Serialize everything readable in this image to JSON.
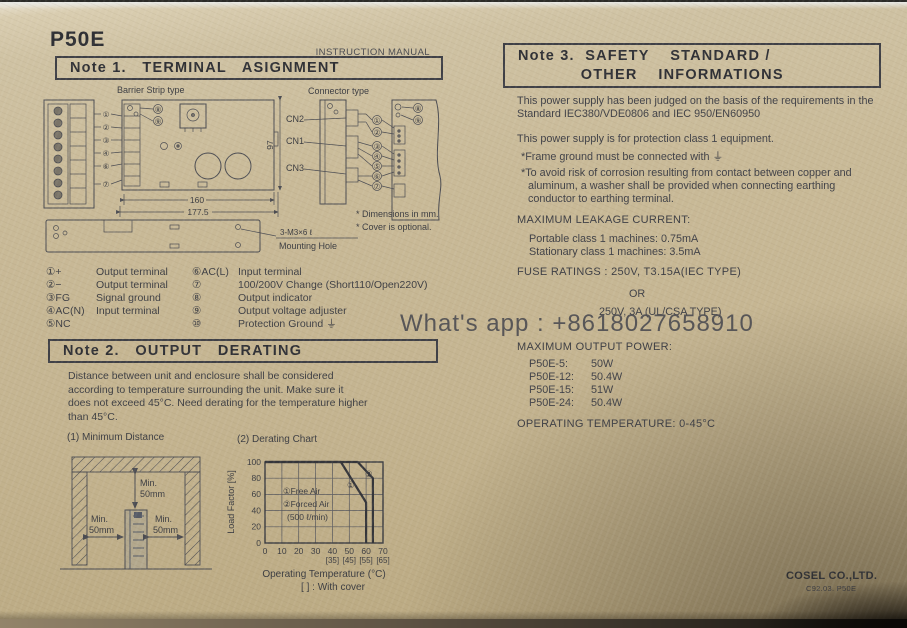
{
  "page": {
    "product_title": "P50E",
    "doc_type": "INSTRUCTION MANUAL",
    "watermark": "What's app : +8618027658910",
    "footer_company": "COSEL CO.,LTD.",
    "footer_code": "C92.03. P50E"
  },
  "note1": {
    "title": "Note 1.   TERMINAL   ASIGNMENT",
    "diagram": {
      "barrier_label": "Barrier Strip type",
      "connector_label": "Connector type",
      "cn2": "CN2",
      "cn1": "CN1",
      "cn3": "CN3",
      "dim_inner": "160",
      "dim_outer": "177.5",
      "dim_height": "97",
      "mounting_spec": "3-M3×6 ℓ",
      "mounting_label": "Mounting Hole",
      "note_dimensions": "* Dimensions in mm.",
      "note_cover": "* Cover is optional.",
      "callouts_left": [
        "①",
        "②",
        "③",
        "④",
        "⑥",
        "⑦"
      ],
      "callouts_mid": [
        "①",
        "②",
        "③",
        "④",
        "⑤",
        "⑥",
        "⑦"
      ],
      "callout_8": "⑧",
      "callout_9": "⑨"
    },
    "legend_left": [
      {
        "head": "①+",
        "desc": "Output terminal"
      },
      {
        "head": "②−",
        "desc": "Output terminal"
      },
      {
        "head": "③FG",
        "desc": "Signal ground"
      },
      {
        "head": "④AC(N)",
        "desc": "Input terminal"
      },
      {
        "head": "⑤NC",
        "desc": ""
      }
    ],
    "legend_right": [
      {
        "head": "⑥AC(L)",
        "desc": "Input terminal"
      },
      {
        "head": "⑦",
        "desc": "100/200V Change (Short110/Open220V)"
      },
      {
        "head": "⑧",
        "desc": "Output indicator"
      },
      {
        "head": "⑨",
        "desc": "Output voltage adjuster"
      },
      {
        "head": "⑩",
        "desc": "Protection Ground ⏚"
      }
    ]
  },
  "note2": {
    "title": "Note 2.   OUTPUT   DERATING",
    "body": "Distance between unit and enclosure shall be considered according to temperature surrounding the unit. Make sure it does not exceed 45°C. Need derating for the temperature higher than 45°C.",
    "fig1_title": "(1) Minimum Distance",
    "fig2_title": "(2) Derating Chart",
    "min_label": {
      "l1": "Min.",
      "l2": "50mm"
    }
  },
  "chart_data": {
    "type": "line",
    "title": "(2) Derating Chart",
    "xlabel": "Operating Temperature (°C)",
    "ylabel": "Load Factor [%]",
    "xlim": [
      0,
      70
    ],
    "ylim": [
      0,
      100
    ],
    "grid": true,
    "x_ticks": [
      "0",
      "10",
      "20",
      "30",
      "40",
      "50",
      "60",
      "70"
    ],
    "x_ticks_with_cover": [
      "[35]",
      "[45]",
      "[55]",
      "[65]"
    ],
    "y_ticks": [
      "0",
      "20",
      "40",
      "60",
      "80",
      "100"
    ],
    "cover_note": "[   ] : With cover",
    "legend": [
      "①Free Air",
      "②Forced Air",
      "(500 ℓ/min)"
    ],
    "legend_position": "inside-left",
    "series": [
      {
        "name": "① Free Air",
        "label": "①",
        "points": [
          [
            0,
            100
          ],
          [
            45,
            100
          ],
          [
            60,
            50
          ],
          [
            60,
            0
          ]
        ]
      },
      {
        "name": "② Forced Air (500 ℓ/min)",
        "label": "②",
        "points": [
          [
            0,
            100
          ],
          [
            55,
            100
          ],
          [
            64,
            80
          ],
          [
            64,
            0
          ]
        ]
      }
    ]
  },
  "note3": {
    "title": "Note 3.  SAFETY    STANDARD /\n            OTHER    INFORMATIONS",
    "item1": "This power supply has been judged on the basis of the requirements in the Standard IEC380/VDE0806 and IEC 950/EN60950",
    "item2": "This power supply is for protection class 1 equipment.",
    "item2_star1": "*Frame ground must be connected with ⏚",
    "item2_star2": "*To avoid risk of corrosion resulting from contact between copper and aluminum, a washer shall be provided when connecting earthing conductor to earthing terminal.",
    "item3_head": "MAXIMUM LEAKAGE CURRENT:",
    "item3_lines": [
      "Portable class 1 machines: 0.75mA",
      "Stationary class 1 machines: 3.5mA"
    ],
    "item4_head": "FUSE RATINGS : 250V, T3.15A(IEC TYPE)",
    "item4_or": "OR",
    "item4_alt": "250V, 3A (UL/CSA TYPE)",
    "item5_head": "MAXIMUM OUTPUT POWER:",
    "item5_rows": [
      {
        "model": "P50E-5:",
        "watts": "50W"
      },
      {
        "model": "P50E-12:",
        "watts": "50.4W"
      },
      {
        "model": "P50E-15:",
        "watts": "51W"
      },
      {
        "model": "P50E-24:",
        "watts": "50.4W"
      }
    ],
    "item6": "OPERATING TEMPERATURE: 0-45°C"
  }
}
